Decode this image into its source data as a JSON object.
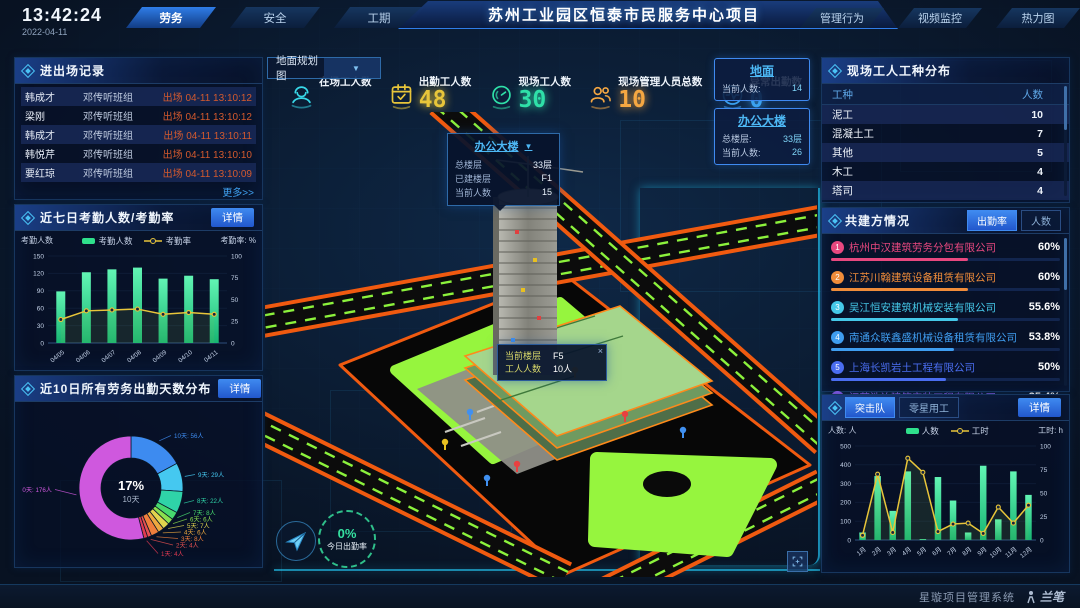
{
  "header": {
    "time": "13:42:24",
    "date": "2022-04-11",
    "left_tabs": [
      {
        "label": "劳务",
        "active": true
      },
      {
        "label": "安全",
        "active": false
      },
      {
        "label": "工期",
        "active": false
      }
    ],
    "title": "苏州工业园区恒泰市民服务中心项目",
    "right_tabs": [
      {
        "label": "管理行为",
        "active": false
      },
      {
        "label": "视频监控",
        "active": false
      },
      {
        "label": "热力图",
        "active": false
      }
    ]
  },
  "panels": {
    "entry": {
      "title": "进出场记录",
      "more": "更多>>",
      "rows": [
        {
          "name": "韩成才",
          "team": "邓传听班组",
          "event": "出场 04-11 13:10:12"
        },
        {
          "name": "梁刚",
          "team": "邓传听班组",
          "event": "出场 04-11 13:10:12"
        },
        {
          "name": "韩成才",
          "team": "邓传听班组",
          "event": "出场 04-11 13:10:11"
        },
        {
          "name": "韩悦芹",
          "team": "邓传听班组",
          "event": "出场 04-11 13:10:10"
        },
        {
          "name": "要红琼",
          "team": "邓传听班组",
          "event": "出场 04-11 13:10:09"
        }
      ]
    },
    "attendance": {
      "title": "近七日考勤人数/考勤率",
      "detail": "详情"
    },
    "workdays": {
      "title": "近10日所有劳务出勤天数分布",
      "detail": "详情"
    },
    "worker_types": {
      "title": "现场工人工种分布",
      "headers": [
        "工种",
        "人数"
      ],
      "rows": [
        {
          "type": "泥工",
          "count": "10"
        },
        {
          "type": "混凝土工",
          "count": "7"
        },
        {
          "type": "其他",
          "count": "5"
        },
        {
          "type": "木工",
          "count": "4"
        },
        {
          "type": "塔司",
          "count": "4"
        }
      ]
    },
    "partners": {
      "title": "共建方情况",
      "tabs": [
        {
          "label": "出勤率",
          "active": true
        },
        {
          "label": "人数",
          "active": false
        }
      ],
      "companies": [
        {
          "rank": "1",
          "name": "杭州中汉建筑劳务分包有限公司",
          "value": "60%",
          "pct": 60,
          "color": "#e8487f"
        },
        {
          "rank": "2",
          "name": "江苏川翰建筑设备租赁有限公司",
          "value": "60%",
          "pct": 60,
          "color": "#f08c3a"
        },
        {
          "rank": "3",
          "name": "吴江恒安建筑机械安装有限公司",
          "value": "55.6%",
          "pct": 55.6,
          "color": "#45c8e8"
        },
        {
          "rank": "4",
          "name": "南通众联鑫盛机械设备租赁有限公司",
          "value": "53.8%",
          "pct": 53.8,
          "color": "#3f9df0"
        },
        {
          "rank": "5",
          "name": "上海长凯岩土工程有限公司",
          "value": "50%",
          "pct": 50,
          "color": "#4a6df0"
        },
        {
          "rank": "6",
          "name": "江苏浩诒建筑安装工程有限公司",
          "value": "35.4%",
          "pct": 35.4,
          "color": "#8a5cf0"
        }
      ]
    },
    "squad": {
      "tabs": [
        {
          "label": "突击队",
          "active": true
        },
        {
          "label": "零星用工",
          "active": false
        }
      ],
      "detail": "详情"
    }
  },
  "scene": {
    "layer_select": "地面规划图",
    "stats": [
      {
        "label": "在场工人数",
        "value": "",
        "color": "#38d8e8",
        "icon": "worker"
      },
      {
        "label": "出勤工人数",
        "value": "48",
        "color": "#e8c53a",
        "icon": "calendar"
      },
      {
        "label": "现场工人数",
        "value": "30",
        "color": "#2fe0a8",
        "icon": "gauge"
      },
      {
        "label": "现场管理人员总数",
        "value": "10",
        "color": "#f5a742",
        "icon": "people"
      },
      {
        "label": "异常出勤数",
        "value": "0",
        "color": "#3fa9f5",
        "icon": "pulse"
      }
    ],
    "building_popup": {
      "title": "办公大楼",
      "rows": [
        [
          "总楼层",
          "33层"
        ],
        [
          "已建楼层",
          "F1"
        ],
        [
          "当前人数",
          "15"
        ]
      ]
    },
    "floor_tooltip": {
      "close": "×",
      "rows": [
        [
          "当前楼层",
          "F5"
        ],
        [
          "工人人数",
          "10人"
        ]
      ]
    },
    "side_cards": [
      {
        "title": "地面",
        "rows": [
          [
            "当前人数:",
            "14"
          ]
        ]
      },
      {
        "title": "办公大楼",
        "rows": [
          [
            "总楼层:",
            "33层"
          ],
          [
            "当前人数:",
            "26"
          ]
        ]
      }
    ],
    "gauge": {
      "value": "0%",
      "label": "今日出勤率"
    }
  },
  "footer": {
    "system_name": "星璇项目管理系统",
    "logo_text": "兰笔"
  },
  "chart_data": [
    {
      "id": "attendance",
      "type": "bar",
      "title": "近七日考勤人数/考勤率",
      "categories": [
        "04/05",
        "04/06",
        "04/07",
        "04/08",
        "04/09",
        "04/10",
        "04/11"
      ],
      "series": [
        {
          "name": "考勤人数",
          "type": "bar",
          "axis": "left",
          "color": "#2fe08c",
          "values": [
            89,
            122,
            127,
            130,
            111,
            116,
            110
          ]
        },
        {
          "name": "考勤率",
          "type": "line",
          "axis": "right",
          "color": "#e8c53a",
          "values": [
            27,
            37,
            38,
            39,
            33,
            35,
            33
          ]
        }
      ],
      "left_axis": {
        "label": "考勤人数",
        "min": 0,
        "max": 150,
        "step": 30
      },
      "right_axis": {
        "label": "考勤率: %",
        "min": 0,
        "max": 100,
        "step": 25
      },
      "legend_position": "top"
    },
    {
      "id": "workdays",
      "type": "pie",
      "title": "近10日所有劳务出勤天数分布",
      "unit": "人",
      "center_label": {
        "pct": "17%",
        "day": "10天"
      },
      "slices": [
        {
          "label": "10天",
          "value": 56,
          "color": "#3d8bf0"
        },
        {
          "label": "9天",
          "value": 29,
          "color": "#45c8f0"
        },
        {
          "label": "8天",
          "value": 22,
          "color": "#2fd3a8"
        },
        {
          "label": "7天",
          "value": 8,
          "color": "#46d86e"
        },
        {
          "label": "6天",
          "value": 6,
          "color": "#8adf4e"
        },
        {
          "label": "5天",
          "value": 7,
          "color": "#e0d44e"
        },
        {
          "label": "4天",
          "value": 6,
          "color": "#eda93f"
        },
        {
          "label": "3天",
          "value": 8,
          "color": "#ef7f3c"
        },
        {
          "label": "2天",
          "value": 4,
          "color": "#e65050"
        },
        {
          "label": "1天",
          "value": 4,
          "color": "#e03a52"
        },
        {
          "label": "0天",
          "value": 176,
          "color": "#cf58de"
        }
      ]
    },
    {
      "id": "squad",
      "type": "bar",
      "title": "突击队",
      "categories": [
        "1月",
        "2月",
        "3月",
        "4月",
        "5月",
        "6月",
        "7月",
        "8月",
        "9月",
        "10月",
        "11月",
        "12月"
      ],
      "series": [
        {
          "name": "人数",
          "type": "bar",
          "axis": "left",
          "color": "#2fe08c",
          "values": [
            40,
            340,
            155,
            365,
            5,
            335,
            210,
            40,
            395,
            110,
            365,
            240
          ]
        },
        {
          "name": "工时",
          "type": "line",
          "axis": "right",
          "color": "#e8c53a",
          "values": [
            5,
            70,
            8,
            87,
            72,
            9,
            17,
            18,
            7,
            35,
            18,
            37
          ]
        }
      ],
      "left_axis": {
        "label": "人数: 人",
        "min": 0,
        "max": 500,
        "step": 100
      },
      "right_axis": {
        "label": "工时: h",
        "min": 0,
        "max": 100,
        "step": 25
      },
      "legend_position": "top"
    }
  ]
}
